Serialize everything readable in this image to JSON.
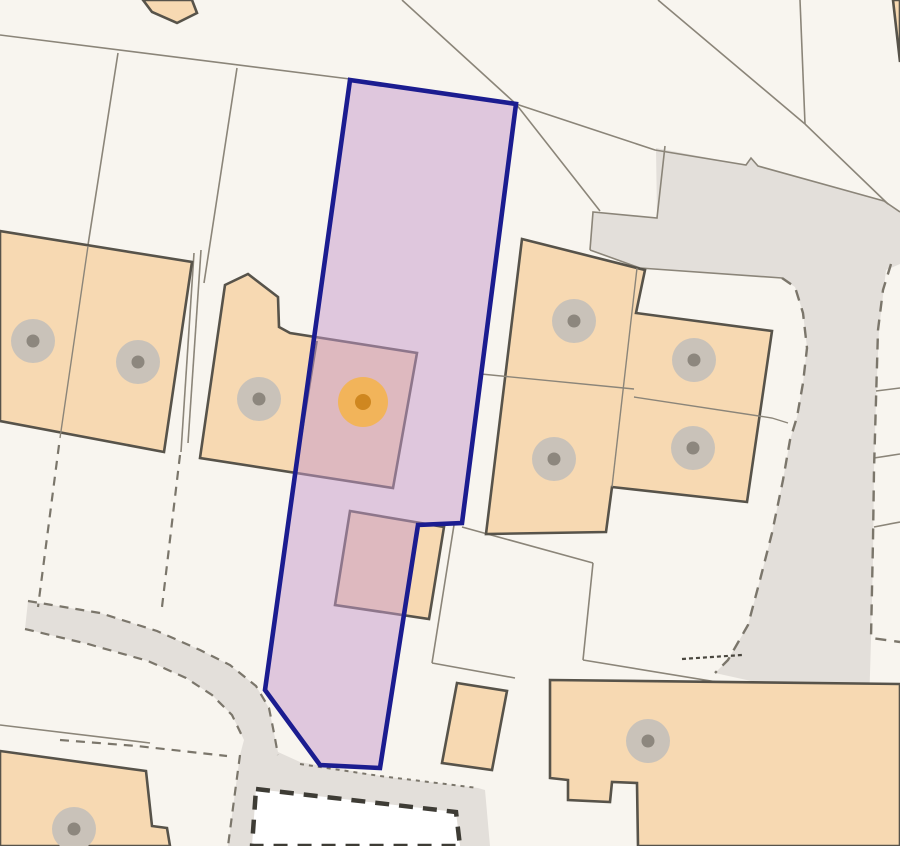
{
  "map": {
    "width": 900,
    "height": 846,
    "palette": {
      "background": "#f8f5ef",
      "road_fill": "#e3dfda",
      "boundary_line": "#8b8579",
      "dashed_line": "#7b766b",
      "building_fill": "#f7d9b2",
      "building_stroke": "#57534a",
      "construction_fill": "#ffffff",
      "construction_dash": "#3e3c35",
      "parcel_fill": "rgba(198,153,204,0.5)",
      "parcel_stroke": "#1b1c90",
      "marker_halo": "#c9c2b9",
      "marker_dot": "#8d877e",
      "selected_halo": "#f2b45a",
      "selected_dot": "#cf8720"
    },
    "roads": [
      {
        "name": "road-surface-east",
        "points": "656,148 746,165 751,158 758,166 884,201 900,212 900,264 886,270 879,330 876,400 874,470 873,560 871,640 869,707 715,673 728,660 748,625 760,580 772,533 783,480 790,440 797,417 803,383 807,348 803,313 795,287 782,278 640,268 590,250 593,212 657,218"
      },
      {
        "name": "footpath-surface-southwest",
        "points": "28,601 100,613 157,631 200,650 230,665 256,686 269,708 274,733 278,752 300,762 380,776 478,788 485,790 490,846 228,846 234,800 240,755 244,740 232,715 212,695 186,678 148,661 88,644 25,629"
      }
    ],
    "construction_area": {
      "name": "construction-plot",
      "points": "256,789 456,812 460,846 252,846"
    },
    "lines": [
      {
        "name": "plot-boundary",
        "points": "0,35 350,79",
        "style": "solid"
      },
      {
        "name": "plot-boundary",
        "points": "402,0 516,104 600,211",
        "style": "solid"
      },
      {
        "name": "plot-boundary",
        "points": "658,0 805,124",
        "style": "solid"
      },
      {
        "name": "plot-boundary",
        "points": "800,0 805,124",
        "style": "solid"
      },
      {
        "name": "plot-boundary",
        "points": "805,124 888,204",
        "style": "solid"
      },
      {
        "name": "plot-boundary",
        "points": "884,201 900,212",
        "style": "solid"
      },
      {
        "name": "road-edge",
        "points": "516,104 655,150 746,165 751,158 758,166 884,201",
        "style": "solid"
      },
      {
        "name": "road-edge",
        "points": "665,146 657,218 593,212 590,250",
        "style": "solid"
      },
      {
        "name": "road-edge",
        "points": "590,250 640,268 782,278",
        "style": "solid"
      },
      {
        "name": "plot-boundary",
        "points": "118,53 88,245",
        "style": "solid"
      },
      {
        "name": "plot-boundary",
        "points": "237,68 204,283",
        "style": "solid"
      },
      {
        "name": "plot-boundary",
        "points": "194,253 181,452",
        "style": "solid"
      },
      {
        "name": "plot-boundary",
        "points": "201,250 188,443",
        "style": "solid"
      },
      {
        "name": "plot-boundary",
        "points": "462,527 593,563",
        "style": "solid"
      },
      {
        "name": "plot-boundary",
        "points": "454,525 432,663",
        "style": "solid"
      },
      {
        "name": "plot-boundary",
        "points": "593,563 583,660",
        "style": "solid"
      },
      {
        "name": "road-edge",
        "points": "583,660 900,712",
        "style": "solid"
      },
      {
        "name": "plot-boundary",
        "points": "432,663 515,678",
        "style": "solid"
      },
      {
        "name": "plot-boundary",
        "points": "0,725 150,743",
        "style": "solid"
      },
      {
        "name": "parking-bay-line",
        "points": "876,391 900,388",
        "style": "solid"
      },
      {
        "name": "parking-bay-line",
        "points": "874,458 900,454",
        "style": "solid"
      },
      {
        "name": "parking-bay-line",
        "points": "874,527 900,522",
        "style": "solid"
      },
      {
        "name": "fence-dashed",
        "points": "59,445 38,607",
        "style": "dashed"
      },
      {
        "name": "fence-dashed",
        "points": "180,455 162,607",
        "style": "dashed"
      },
      {
        "name": "footpath-edge-dashed",
        "points": "28,601 100,613 157,631 200,650 230,665 256,686 269,708 274,733 278,755",
        "style": "dashed"
      },
      {
        "name": "footpath-edge-dashed",
        "points": "25,629 88,644 148,661 186,678 212,695 232,715 244,740",
        "style": "dashed"
      },
      {
        "name": "fence-dashed",
        "points": "240,755 234,800 228,846",
        "style": "dashed"
      },
      {
        "name": "fence-dashed",
        "points": "60,740 137,746 227,756",
        "style": "dashed"
      },
      {
        "name": "footpath-edge-dotted",
        "points": "300,764 380,776 478,788",
        "style": "dotted"
      },
      {
        "name": "road-edge-dashed",
        "points": "782,278 795,287 803,313 807,348 803,383 797,417 790,440 783,480 772,533 760,580 748,625 728,660 715,673",
        "style": "long-dash"
      },
      {
        "name": "road-edge-dashed",
        "points": "891,264 883,290 878,330 876,400 874,470 873,540 871,638 900,642",
        "style": "long-dash"
      },
      {
        "name": "map-annotation-marks",
        "points": "682,659 742,655",
        "style": "fine-dash"
      }
    ],
    "buildings": [
      {
        "name": "building-top-gable",
        "points": "143,0 192,0 197,13 177,23 152,12"
      },
      {
        "name": "building-semi-pair-west",
        "points": "0,231 192,262 164,452 0,421"
      },
      {
        "name": "building-subject-house",
        "points": "225,285 248,274 278,297 279,327 290,333 417,353 393,488 200,458"
      },
      {
        "name": "building-block-east",
        "points": "522,239 645,270 636,313 772,331 747,502 612,487 606,532 486,534"
      },
      {
        "name": "building-outbuilding-mid",
        "points": "350,511 444,527 429,619 335,605"
      },
      {
        "name": "building-outbuilding-south",
        "points": "457,683 507,691 492,770 442,763"
      },
      {
        "name": "building-southwest",
        "points": "0,751 146,771 152,826 167,828 170,846 0,846"
      },
      {
        "name": "building-southeast",
        "points": "550,680 900,684 900,846 638,846 637,783 612,782 610,802 568,800 568,780 550,778"
      },
      {
        "name": "building-northeast-sliver",
        "points": "893,0 900,0 900,62"
      }
    ],
    "building_lines": [
      {
        "name": "unit-division-line",
        "points": "88,246 60,438",
        "style": "thin"
      },
      {
        "name": "unit-division-line",
        "points": "637,268 612,487",
        "style": "thin"
      },
      {
        "name": "garden-division-line",
        "points": "481,374 634,389",
        "style": "thin"
      },
      {
        "name": "garden-division-line",
        "points": "634,397 772,418 788,423",
        "style": "thin"
      },
      {
        "name": "party-wall-line",
        "points": "317,341 295,476",
        "style": "wall"
      }
    ],
    "markers": {
      "property_points": [
        {
          "x": 33,
          "y": 341
        },
        {
          "x": 138,
          "y": 362
        },
        {
          "x": 259,
          "y": 399
        },
        {
          "x": 574,
          "y": 321
        },
        {
          "x": 694,
          "y": 360
        },
        {
          "x": 554,
          "y": 459
        },
        {
          "x": 693,
          "y": 448
        },
        {
          "x": 74,
          "y": 829
        },
        {
          "x": 648,
          "y": 741
        }
      ],
      "selected": {
        "x": 363,
        "y": 402
      }
    },
    "parcel": {
      "name": "title-boundary-parcel",
      "points": "350,80 516,104 462,523 418,525 380,768 320,765 265,690"
    }
  }
}
